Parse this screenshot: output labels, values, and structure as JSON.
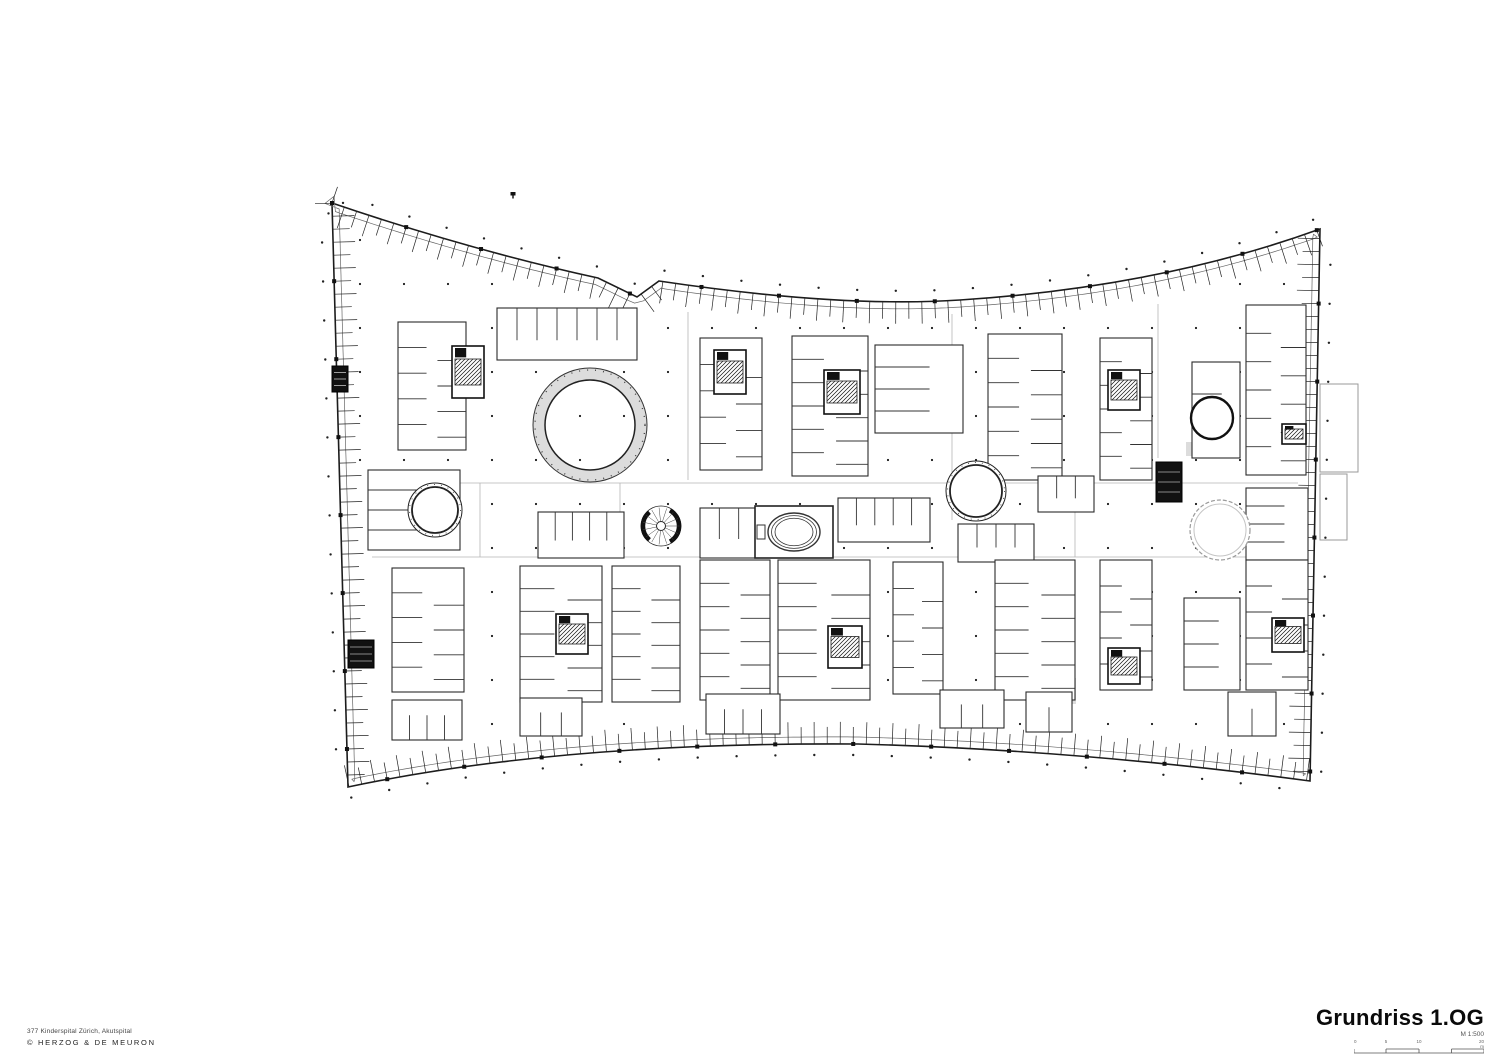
{
  "sheet": {
    "width": 1512,
    "height": 1055,
    "background": "#ffffff"
  },
  "title_block": {
    "title": "Grundriss 1.OG",
    "scale_label": "M 1:500",
    "scale_bar_labels": [
      "0",
      "5",
      "10",
      "20 m"
    ]
  },
  "credits": {
    "project": "377 Kinderspital Zürich, Akutspital",
    "copyright": "© HERZOG & DE MEURON"
  },
  "colors": {
    "line": "#1c1c1c",
    "wall": "#2a2a2a",
    "light_line": "#b5b5b5",
    "inner_line": "#666666",
    "gray_fill": "#dcdcdc",
    "core_line": "#111111"
  },
  "plan": {
    "outline": {
      "path": "M 332 203 Q 470 250 598 278 L 637 297 L 659 281 Q 840 308 960 300 Q 1160 287 1320 229 L 1310 781 Q 1080 750 858 744 Q 560 742 348 787 Z",
      "tick_spacing": 13,
      "tick_len_short": 17,
      "tick_len_long": 22
    },
    "marker_dot": {
      "x": 513,
      "y": 192
    },
    "annex_boxes": [
      {
        "x": 1320,
        "y": 384,
        "w": 38,
        "h": 88
      },
      {
        "x": 1320,
        "y": 474,
        "w": 27,
        "h": 66
      }
    ],
    "corridors": [
      [
        372,
        483,
        1298,
        483
      ],
      [
        372,
        557,
        1294,
        557
      ],
      [
        688,
        312,
        688,
        480
      ],
      [
        952,
        314,
        952,
        520
      ],
      [
        1158,
        304,
        1158,
        458
      ],
      [
        480,
        483,
        480,
        557
      ],
      [
        620,
        483,
        620,
        557
      ],
      [
        1075,
        483,
        1075,
        557
      ]
    ],
    "gray_zones": [
      {
        "x": 416,
        "y": 326,
        "w": 40,
        "h": 20
      },
      {
        "x": 418,
        "y": 424,
        "w": 38,
        "h": 22
      },
      {
        "x": 902,
        "y": 564,
        "w": 34,
        "h": 126
      },
      {
        "x": 1186,
        "y": 442,
        "w": 52,
        "h": 14
      },
      {
        "x": 1186,
        "y": 612,
        "w": 52,
        "h": 70
      },
      {
        "x": 646,
        "y": 654,
        "w": 34,
        "h": 38
      },
      {
        "x": 1030,
        "y": 678,
        "w": 46,
        "h": 26
      },
      {
        "x": 900,
        "y": 362,
        "w": 38,
        "h": 40
      }
    ],
    "blocks": [
      {
        "x": 398,
        "y": 322,
        "w": 68,
        "h": 128,
        "dir": "h",
        "n": 4,
        "side": "both"
      },
      {
        "x": 497,
        "y": 308,
        "w": 140,
        "h": 52,
        "dir": "v",
        "n": 6,
        "side": "top"
      },
      {
        "x": 700,
        "y": 338,
        "w": 62,
        "h": 132,
        "dir": "h",
        "n": 4,
        "side": "both"
      },
      {
        "x": 792,
        "y": 336,
        "w": 76,
        "h": 140,
        "dir": "h",
        "n": 5,
        "side": "both"
      },
      {
        "x": 875,
        "y": 345,
        "w": 88,
        "h": 88,
        "dir": "h",
        "n": 3,
        "side": "left"
      },
      {
        "x": 988,
        "y": 334,
        "w": 74,
        "h": 146,
        "dir": "h",
        "n": 5,
        "side": "both"
      },
      {
        "x": 1100,
        "y": 338,
        "w": 52,
        "h": 142,
        "dir": "h",
        "n": 5,
        "side": "both"
      },
      {
        "x": 1192,
        "y": 362,
        "w": 48,
        "h": 96,
        "dir": "h",
        "n": 2,
        "side": "left"
      },
      {
        "x": 1246,
        "y": 305,
        "w": 60,
        "h": 170,
        "dir": "h",
        "n": 5,
        "side": "both"
      },
      {
        "x": 538,
        "y": 512,
        "w": 86,
        "h": 46,
        "dir": "v",
        "n": 4,
        "side": "top"
      },
      {
        "x": 700,
        "y": 508,
        "w": 58,
        "h": 50,
        "dir": "v",
        "n": 2,
        "side": "top"
      },
      {
        "x": 838,
        "y": 498,
        "w": 92,
        "h": 44,
        "dir": "v",
        "n": 4,
        "side": "top"
      },
      {
        "x": 958,
        "y": 524,
        "w": 76,
        "h": 38,
        "dir": "v",
        "n": 3,
        "side": "top"
      },
      {
        "x": 1038,
        "y": 476,
        "w": 56,
        "h": 36,
        "dir": "v",
        "n": 2,
        "side": "top"
      },
      {
        "x": 1246,
        "y": 488,
        "w": 62,
        "h": 72,
        "dir": "h",
        "n": 3,
        "side": "left"
      },
      {
        "x": 368,
        "y": 470,
        "w": 92,
        "h": 80,
        "dir": "h",
        "n": 3,
        "side": "left"
      },
      {
        "x": 392,
        "y": 568,
        "w": 72,
        "h": 124,
        "dir": "h",
        "n": 4,
        "side": "both"
      },
      {
        "x": 520,
        "y": 566,
        "w": 82,
        "h": 136,
        "dir": "h",
        "n": 5,
        "side": "both"
      },
      {
        "x": 612,
        "y": 566,
        "w": 68,
        "h": 136,
        "dir": "h",
        "n": 5,
        "side": "both"
      },
      {
        "x": 700,
        "y": 560,
        "w": 70,
        "h": 140,
        "dir": "h",
        "n": 5,
        "side": "both"
      },
      {
        "x": 778,
        "y": 560,
        "w": 92,
        "h": 140,
        "dir": "h",
        "n": 5,
        "side": "both"
      },
      {
        "x": 893,
        "y": 562,
        "w": 50,
        "h": 132,
        "dir": "h",
        "n": 4,
        "side": "both"
      },
      {
        "x": 995,
        "y": 560,
        "w": 80,
        "h": 140,
        "dir": "h",
        "n": 5,
        "side": "both"
      },
      {
        "x": 1100,
        "y": 560,
        "w": 52,
        "h": 130,
        "dir": "h",
        "n": 4,
        "side": "both"
      },
      {
        "x": 1184,
        "y": 598,
        "w": 56,
        "h": 92,
        "dir": "h",
        "n": 3,
        "side": "left"
      },
      {
        "x": 1246,
        "y": 560,
        "w": 62,
        "h": 130,
        "dir": "h",
        "n": 4,
        "side": "both"
      },
      {
        "x": 392,
        "y": 700,
        "w": 70,
        "h": 40,
        "dir": "v",
        "n": 3,
        "side": "bottom"
      },
      {
        "x": 520,
        "y": 698,
        "w": 62,
        "h": 38,
        "dir": "v",
        "n": 2,
        "side": "bottom"
      },
      {
        "x": 706,
        "y": 694,
        "w": 74,
        "h": 40,
        "dir": "v",
        "n": 3,
        "side": "bottom"
      },
      {
        "x": 940,
        "y": 690,
        "w": 64,
        "h": 38,
        "dir": "v",
        "n": 2,
        "side": "bottom"
      },
      {
        "x": 1026,
        "y": 692,
        "w": 46,
        "h": 40,
        "dir": "v",
        "n": 1,
        "side": "bottom"
      },
      {
        "x": 1228,
        "y": 692,
        "w": 48,
        "h": 44,
        "dir": "v",
        "n": 1,
        "side": "bottom"
      }
    ],
    "cores": [
      {
        "x": 452,
        "y": 346,
        "w": 32,
        "h": 52
      },
      {
        "x": 714,
        "y": 350,
        "w": 32,
        "h": 44
      },
      {
        "x": 824,
        "y": 370,
        "w": 36,
        "h": 44
      },
      {
        "x": 1108,
        "y": 370,
        "w": 32,
        "h": 40
      },
      {
        "x": 556,
        "y": 614,
        "w": 32,
        "h": 40
      },
      {
        "x": 828,
        "y": 626,
        "w": 34,
        "h": 42
      },
      {
        "x": 1108,
        "y": 648,
        "w": 32,
        "h": 36
      },
      {
        "x": 1272,
        "y": 618,
        "w": 32,
        "h": 34
      },
      {
        "x": 348,
        "y": 640,
        "w": 26,
        "h": 28,
        "solid": true
      },
      {
        "x": 1156,
        "y": 462,
        "w": 26,
        "h": 40,
        "solid": true
      },
      {
        "x": 332,
        "y": 366,
        "w": 16,
        "h": 26,
        "solid": true
      },
      {
        "x": 1282,
        "y": 424,
        "w": 24,
        "h": 20
      }
    ],
    "circles": [
      {
        "name": "atrium-ring",
        "cx": 590,
        "cy": 425,
        "r": 57,
        "r_inner": 45,
        "style": "ring"
      },
      {
        "name": "courtyard-west",
        "cx": 435,
        "cy": 510,
        "r": 27,
        "style": "double"
      },
      {
        "name": "courtyard-center",
        "cx": 976,
        "cy": 491,
        "r": 30,
        "style": "double"
      },
      {
        "name": "courtyard-east-small",
        "cx": 1212,
        "cy": 418,
        "r": 21,
        "style": "bold"
      },
      {
        "name": "void-east",
        "cx": 1220,
        "cy": 530,
        "r": 30,
        "style": "gray"
      }
    ],
    "ellipse_room": {
      "rect": {
        "x": 755,
        "y": 506,
        "w": 78,
        "h": 52
      },
      "cx": 794,
      "cy": 532,
      "rx": 26,
      "ry": 19
    },
    "spiral_stair": {
      "cx": 661,
      "cy": 526,
      "r": 20
    },
    "column_grid": {
      "x0": 360,
      "x1": 1305,
      "y0": 240,
      "y1": 772,
      "step": 44
    }
  }
}
